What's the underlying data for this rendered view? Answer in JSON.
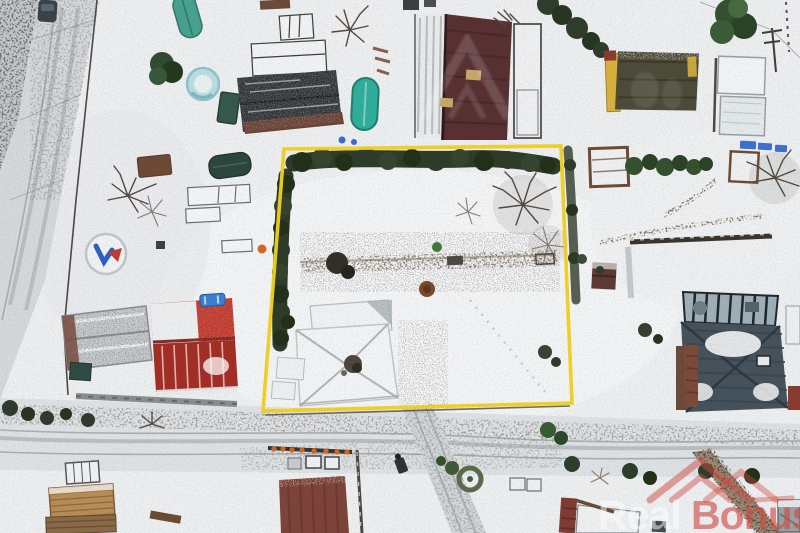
{
  "image": {
    "type": "aerial-drone-photo",
    "subject": "top-down winter aerial view of snow-covered residential plots; one land parcel outlined in yellow with a hedge, garden and hip-roof house inside"
  },
  "watermark": {
    "text_light": "Real",
    "text_accent": "Bonus",
    "icon": "double-roof-house-icon"
  },
  "colors": {
    "snow": "#edeff1",
    "road": "#d6d9db",
    "boundary-yellow": "#f2d11f",
    "hedge-green": "#2d3b28",
    "conifer-green": "#33502f",
    "maroon-roof": "#583031",
    "charcoal-roof": "#33373a",
    "red-roof": "#c03a2e",
    "dark-red-roof": "#a32d24",
    "slate-roof": "#45525c",
    "rust-roof": "#7e4338",
    "teal-tank": "#2fae9b",
    "teal-boat": "#48a18f",
    "pool-blue": "#bcdde2",
    "car-blue": "#3b7fd4",
    "yellow-wall": "#d9b23c",
    "lumber-tan": "#b98d54",
    "dirt-brown": "#8d7f68",
    "watermark-red": "#cf4a42",
    "watermark-white": "#ffffff"
  },
  "features": {
    "plot": "yellow-outlined parcel with conifer hedge on north and west sides, bare trees east, snow-covered hip-roof house southwest",
    "neighbors": "red gable-roof house west, maroon-roof building north, yellow-wall cottage northeast, slate hip-roof house with conservatory southeast",
    "objects": "trampoline with logo, round pool, teal tank, boat cover, greenhouse, lumber stacks, cars, garden beds",
    "ground": "snow, plowed roads with tire tracks, dirt garden paths"
  }
}
